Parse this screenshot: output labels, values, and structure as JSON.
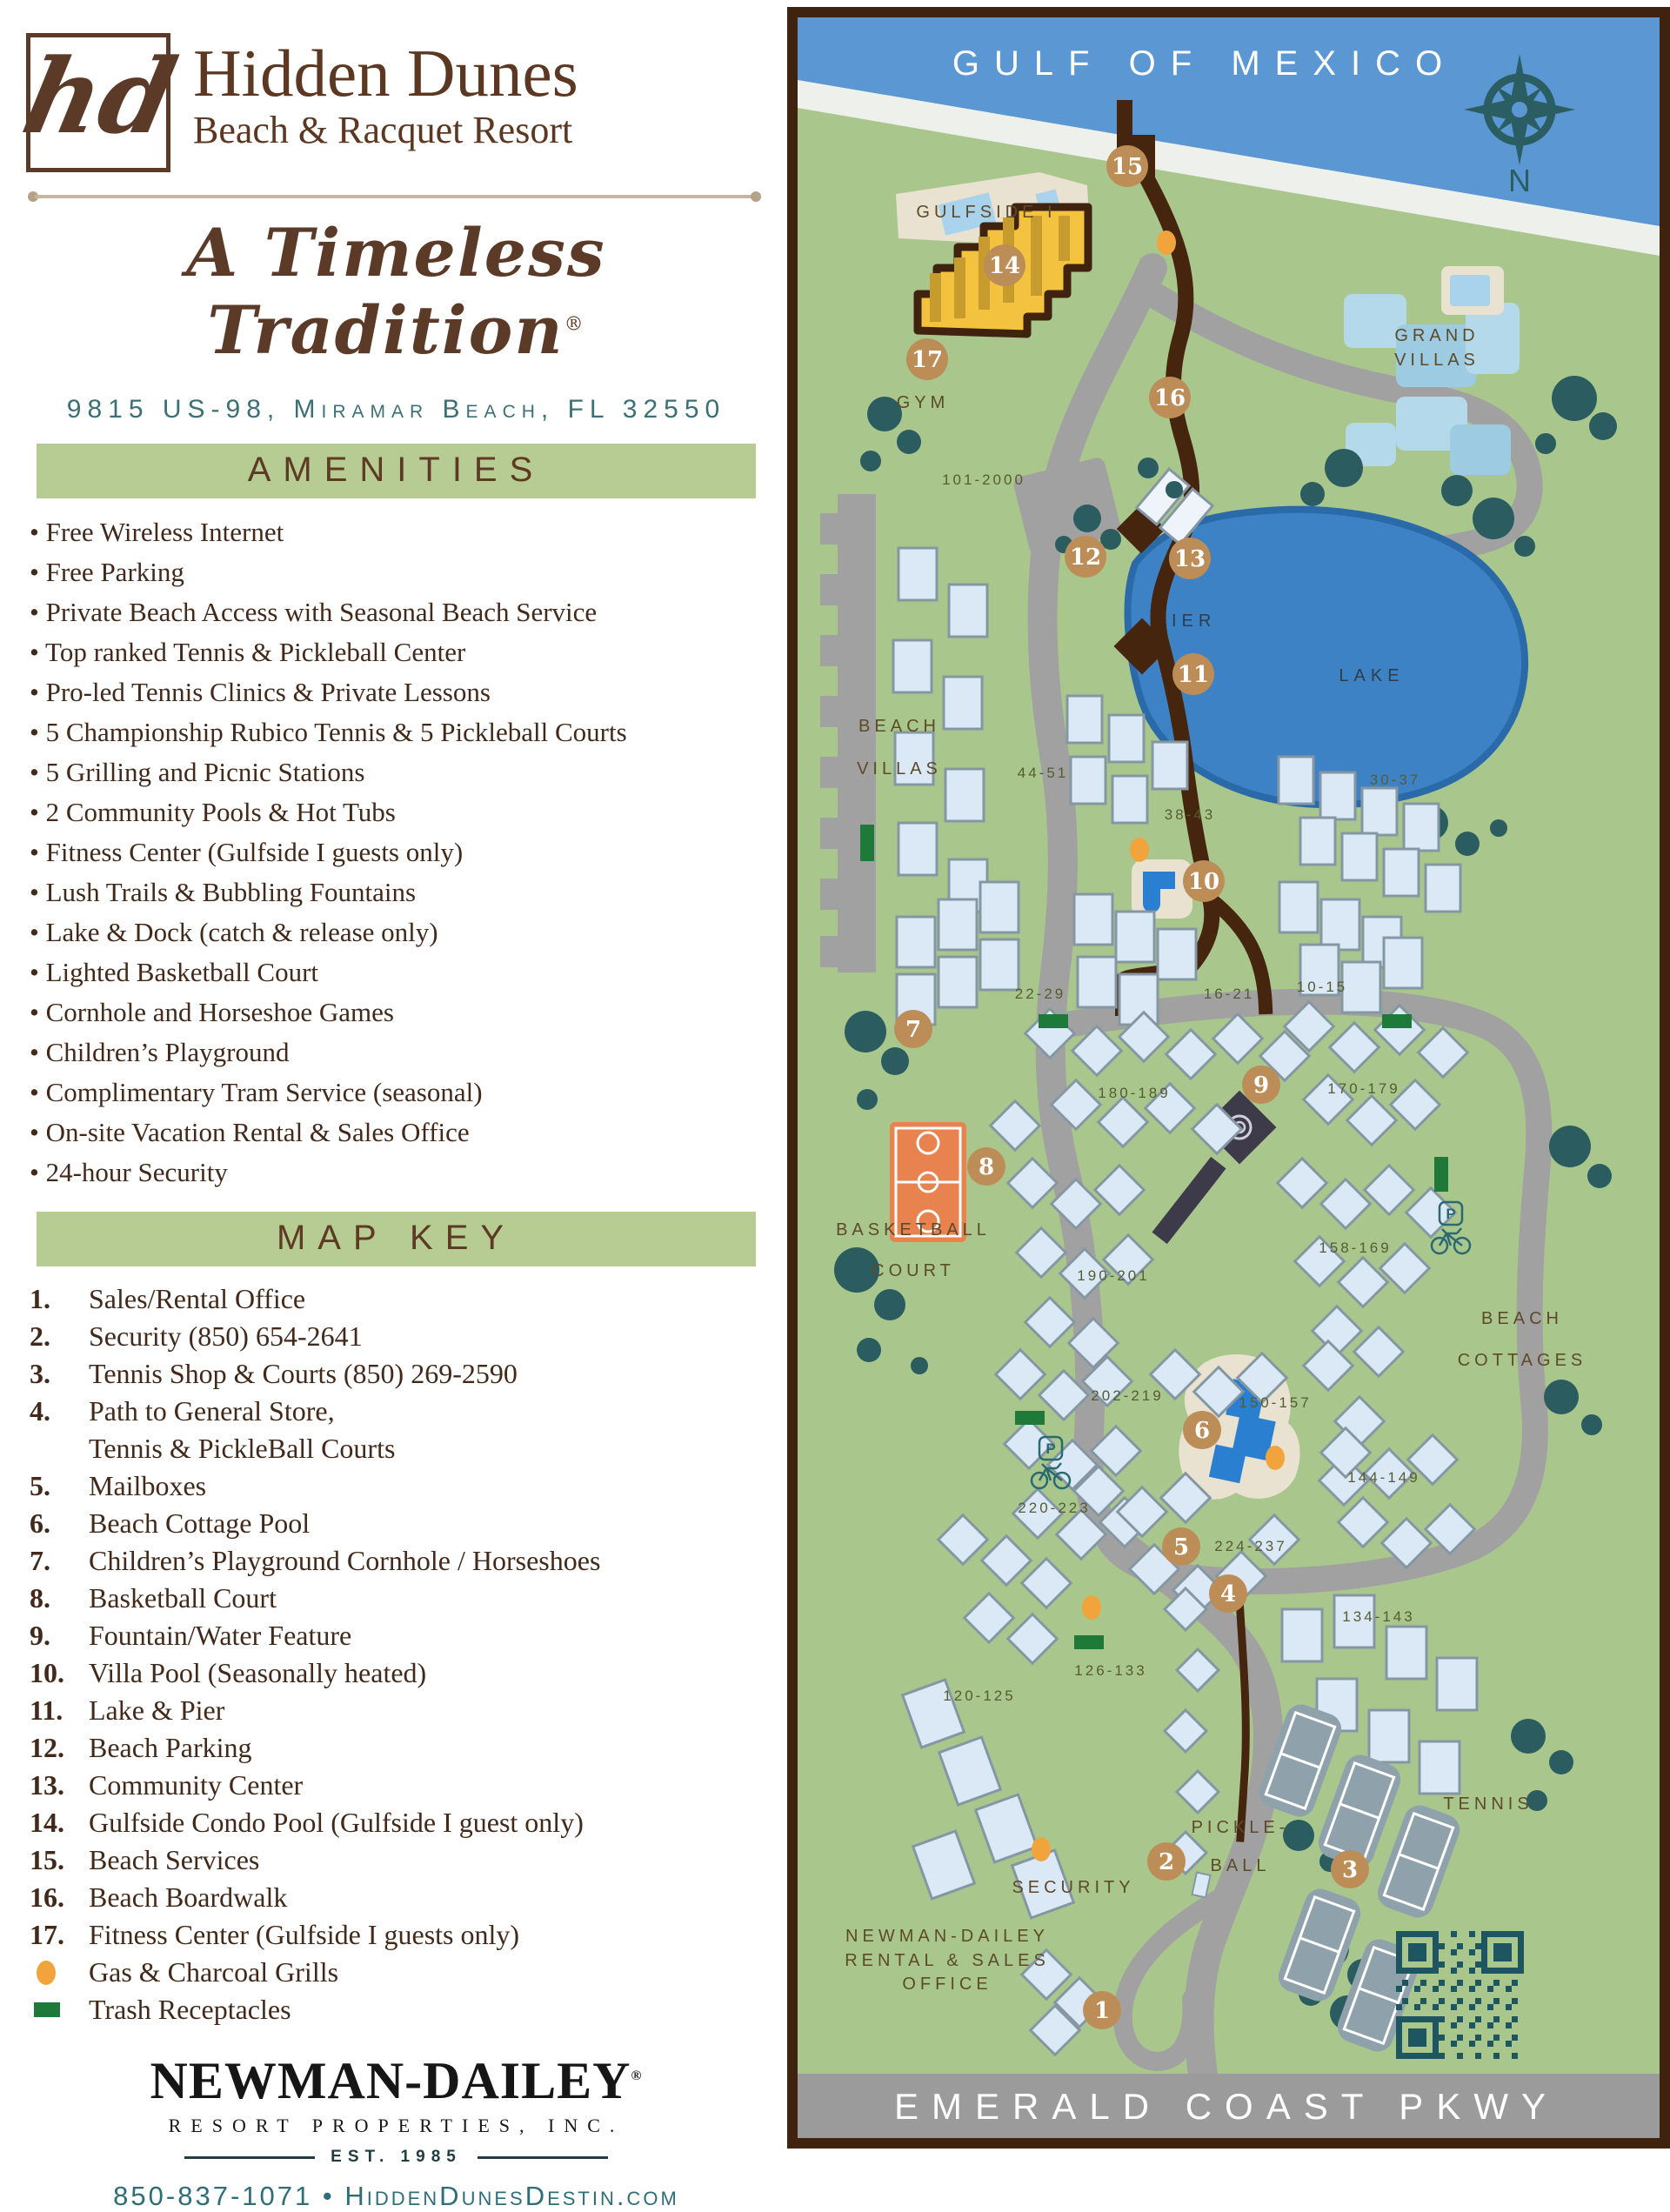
{
  "branding": {
    "monogram": "hd",
    "name_line1": "Hidden Dunes",
    "name_line2": "Beach & Racquet Resort",
    "tagline": "A Timeless Tradition",
    "registered": "®",
    "address": "9815 US-98, Miramar Beach, FL 32550"
  },
  "amenities": {
    "heading": "AMENITIES",
    "items": [
      "Free Wireless Internet",
      "Free Parking",
      "Private Beach Access with Seasonal Beach Service",
      "Top ranked Tennis & Pickleball Center",
      "Pro-led Tennis Clinics & Private Lessons",
      "5 Championship Rubico Tennis & 5 Pickleball Courts",
      "5 Grilling and Picnic Stations",
      "2 Community Pools & Hot Tubs",
      "Fitness Center (Gulfside I guests only)",
      "Lush Trails & Bubbling Fountains",
      "Lake & Dock (catch & release only)",
      "Lighted Basketball Court",
      "Cornhole and Horseshoe Games",
      "Children’s Playground",
      "Complimentary Tram Service (seasonal)",
      "On-site Vacation Rental & Sales Office",
      "24-hour Security"
    ]
  },
  "map_key": {
    "heading": "MAP KEY",
    "items": [
      {
        "num": "1.",
        "label": "Sales/Rental Office"
      },
      {
        "num": "2.",
        "label": "Security (850) 654-2641"
      },
      {
        "num": "3.",
        "label": "Tennis Shop & Courts (850) 269-2590"
      },
      {
        "num": "4.",
        "label": "Path to General Store,",
        "label2": "Tennis & PickleBall Courts"
      },
      {
        "num": "5.",
        "label": "Mailboxes"
      },
      {
        "num": "6.",
        "label": "Beach Cottage Pool"
      },
      {
        "num": "7.",
        "label": "Children’s Playground Cornhole / Horseshoes"
      },
      {
        "num": "8.",
        "label": "Basketball Court"
      },
      {
        "num": "9.",
        "label": "Fountain/Water Feature"
      },
      {
        "num": "10.",
        "label": "Villa Pool (Seasonally heated)"
      },
      {
        "num": "11.",
        "label": "Lake & Pier"
      },
      {
        "num": "12.",
        "label": "Beach Parking"
      },
      {
        "num": "13.",
        "label": "Community Center"
      },
      {
        "num": "14.",
        "label": "Gulfside Condo Pool (Gulfside I guest only)"
      },
      {
        "num": "15.",
        "label": "Beach Services"
      },
      {
        "num": "16.",
        "label": "Beach Boardwalk"
      },
      {
        "num": "17.",
        "label": "Fitness Center (Gulfside I guests only)"
      }
    ],
    "legend": [
      {
        "symbol": "grill",
        "label": "Gas & Charcoal Grills"
      },
      {
        "symbol": "trash",
        "label": "Trash Receptacles"
      }
    ]
  },
  "footer": {
    "company": "NEWMAN-DAILEY",
    "registered": "®",
    "subtitle": "RESORT PROPERTIES, INC.",
    "established": "EST. 1985",
    "phone": "850-837-1071",
    "separator": "•",
    "website": "HiddenDunesDestin.com"
  },
  "map": {
    "labels": {
      "gulf": "GULF OF MEXICO",
      "pkwy": "EMERALD COAST PKWY",
      "compass_n": "N",
      "gulfside": "GULFSIDE I",
      "gym": "GYM",
      "grand_1": "GRAND",
      "grand_2": "VILLAS",
      "beach_villas_1": "BEACH",
      "beach_villas_2": "VILLAS",
      "pier": "PIER",
      "lake": "LAKE",
      "basketball_1": "BASKETBALL",
      "basketball_2": "COURT",
      "beach_cottages_1": "BEACH",
      "beach_cottages_2": "COTTAGES",
      "pickleball_1": "PICKLE-",
      "pickleball_2": "BALL",
      "tennis": "TENNIS",
      "security": "SECURITY",
      "office_1": "NEWMAN-DAILEY",
      "office_2": "RENTAL & SALES",
      "office_3": "OFFICE"
    },
    "unit_ranges": [
      "101-2000",
      "44-51",
      "38-43",
      "30-37",
      "22-29",
      "16-21",
      "10-15",
      "180-189",
      "170-179",
      "190-201",
      "158-169",
      "150-157",
      "202-219",
      "220-223",
      "144-149",
      "224-237",
      "134-143",
      "126-133",
      "120-125"
    ],
    "markers": [
      "1",
      "2",
      "3",
      "4",
      "5",
      "6",
      "7",
      "8",
      "9",
      "10",
      "11",
      "12",
      "13",
      "14",
      "15",
      "16",
      "17"
    ],
    "colors": {
      "map_green": "#a9c78c",
      "sea_blue": "#5b97d3",
      "lake_blue": "#3e82c6",
      "road_gray": "#a1a1a1",
      "border_brown": "#40230f",
      "boardwalk_brown": "#46250e",
      "marker_tan": "#bd8d58",
      "grill_orange": "#f2a43c",
      "trash_green": "#1d7a38",
      "court_orange": "#e8834f",
      "tree_teal": "#2a5c60",
      "building_fill": "#dbe9f6",
      "building_stroke": "#8597a3",
      "heading_bar_green": "#b7cc92",
      "heading_text_brown": "#5d3a24",
      "contact_teal": "#2e6e78",
      "qr_teal": "#1d5560"
    }
  }
}
